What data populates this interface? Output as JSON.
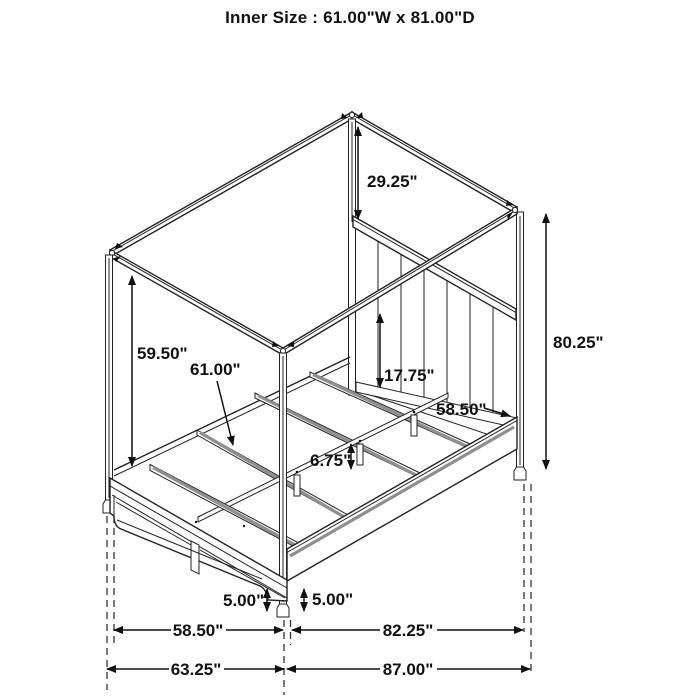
{
  "title": "Inner Size : 61.00\"W x 81.00\"D",
  "diagram_type": "canopy storage bed dimension drawing",
  "dimensions": {
    "canopy_drop": "29.25\"",
    "overall_height": "80.25\"",
    "canopy_underside_height": "59.50\"",
    "inner_width": "61.00\"",
    "headboard_panel_height": "17.75\"",
    "headboard_width": "58.50\"",
    "slat_leg_height": "6.75\"",
    "footboard_clearance": "5.00\"",
    "siderail_clearance": "5.00\"",
    "footboard_floor_width": "58.50\"",
    "siderail_floor_depth": "82.25\"",
    "overall_width": "63.25\"",
    "overall_depth": "87.00\""
  }
}
